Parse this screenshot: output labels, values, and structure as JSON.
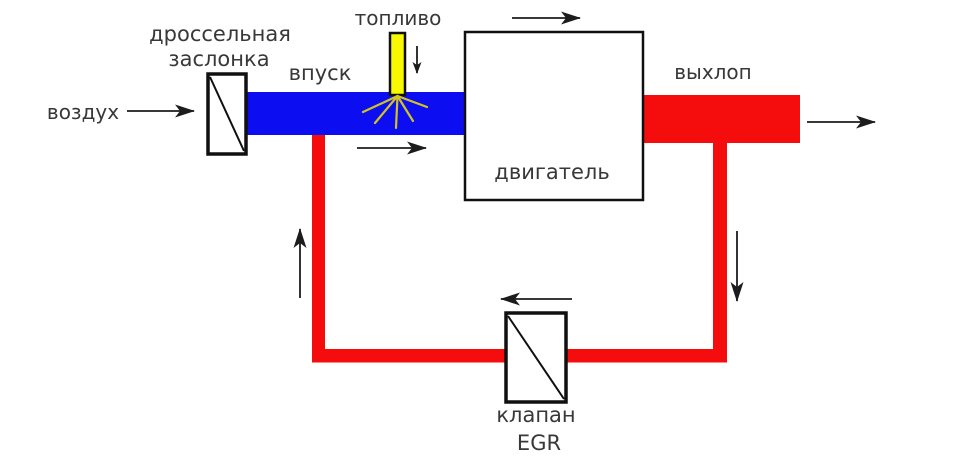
{
  "diagram": {
    "labels": {
      "air": "воздух",
      "throttle_line1": "дроссельная",
      "throttle_line2": "заслонка",
      "intake": "впуск",
      "fuel": "топливо",
      "engine": "двигатель",
      "exhaust": "выхлоп",
      "egr_valve_line1": "клапан",
      "egr_valve_line2": "EGR"
    },
    "colors": {
      "intake_pipe": "#0d0df2",
      "exhaust_pipe": "#f50d0d",
      "fuel_injector": "#f8f800",
      "fuel_spray": "#d2c41e",
      "component_fill": "#ffffff",
      "component_border": "#101010",
      "arrow": "#1c1c1c",
      "text": "#383838"
    }
  }
}
